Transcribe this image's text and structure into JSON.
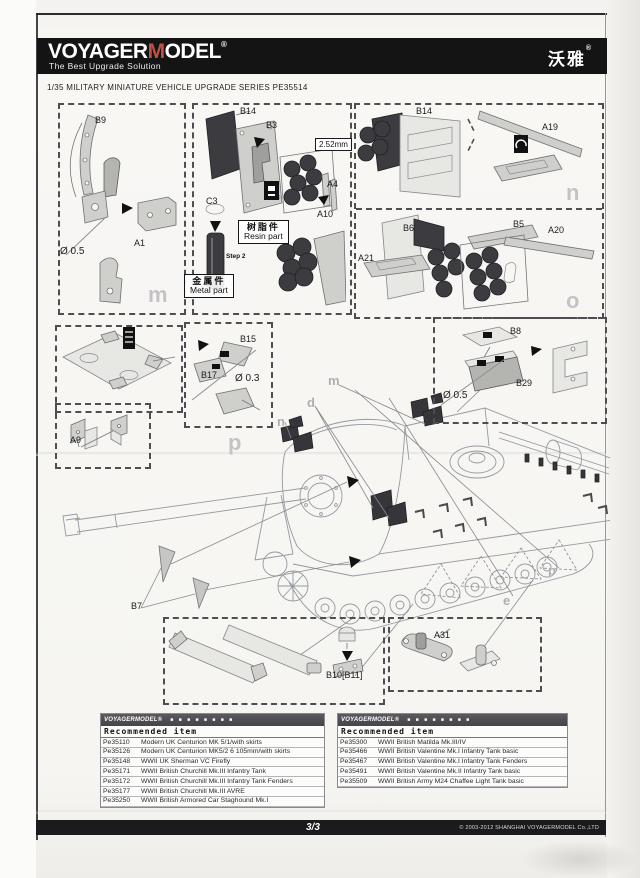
{
  "header": {
    "logo_voyager": "VOYAGER",
    "logo_m": "M",
    "logo_odel": "ODEL",
    "registered": "®",
    "tagline": "The Best Upgrade Solution",
    "brand_cn": "沃雅",
    "brand_cn_reg": "®"
  },
  "series_title": "1/35 MILITARY MINIATURE VEHICLE  UPGRADE SERIES PE35514",
  "callouts": {
    "b9": "B9",
    "a1": "A1",
    "dia05_left": "Ø 0.5",
    "b14_mid": "B14",
    "b3": "B3",
    "dim_252": "2.52mm",
    "a4": "A4",
    "a10": "A10",
    "c3": "C3",
    "step2": "Step 2",
    "resin_cn": "树脂件",
    "resin_en": "Resin part",
    "metal_cn": "金属件",
    "metal_en": "Metal part",
    "b14_right": "B14",
    "a19": "A19",
    "b6": "B6",
    "a21": "A21",
    "b5": "B5",
    "a20": "A20",
    "b15": "B15",
    "b17": "B17",
    "dia03": "Ø 0.3",
    "a9": "A9",
    "b8": "B8",
    "b29": "B29",
    "dia05_right": "Ø 0.5",
    "b7": "B7",
    "b10_b11": "B10[B11]",
    "a31": "A31",
    "wm_m": "m",
    "wm_n": "n",
    "wm_o": "o",
    "wm_p": "p",
    "tank_m": "m",
    "tank_d": "d",
    "tank_n": "n",
    "tank_p": "p",
    "tank_e": "e"
  },
  "tables": {
    "brand": "VOYAGERMODEL®",
    "brand_blocks": "■ ■ ■ ■   ■ ■ ■ ■",
    "left": {
      "title": "Recommended item",
      "rows": [
        {
          "code": "Pe35110",
          "desc": "Modern UK Centurion MK 5/1/with skirts"
        },
        {
          "code": "Pe35126",
          "desc": "Modern UK Centurion MK5/2 6 105mm/with skirts"
        },
        {
          "code": "Pe35148",
          "desc": "WWII UK Sherman VC Firefly"
        },
        {
          "code": "Pe35171",
          "desc": "WWII British Churchill Mk.III Infantry Tank"
        },
        {
          "code": "Pe35172",
          "desc": "WWII British Churchill Mk.III Infantry Tank Fenders"
        },
        {
          "code": "Pe35177",
          "desc": "WWII British Churchill Mk.III AVRE"
        },
        {
          "code": "Pe35250",
          "desc": "WWII British Armored Car Staghound Mk.I"
        }
      ]
    },
    "right": {
      "title": "Recommended item",
      "rows": [
        {
          "code": "Pe35300",
          "desc": "WWII British Matilda Mk.III/IV"
        },
        {
          "code": "Pe35466",
          "desc": "WWII British Valentine Mk.I Infantry Tank basic"
        },
        {
          "code": "Pe35467",
          "desc": "WWII British Valentine Mk.I Infantry Tank Fenders"
        },
        {
          "code": "Pe35491",
          "desc": "WWII British Valentine Mk.II Infantry Tank basic"
        },
        {
          "code": "Pe35509",
          "desc": "WWII British Army M24 Chaffee Light Tank basic"
        }
      ]
    }
  },
  "footer": {
    "page": "3/3",
    "copyright": "© 2003-2012 SHANGHAI VOYAGERMODEL Co.,LTD"
  }
}
